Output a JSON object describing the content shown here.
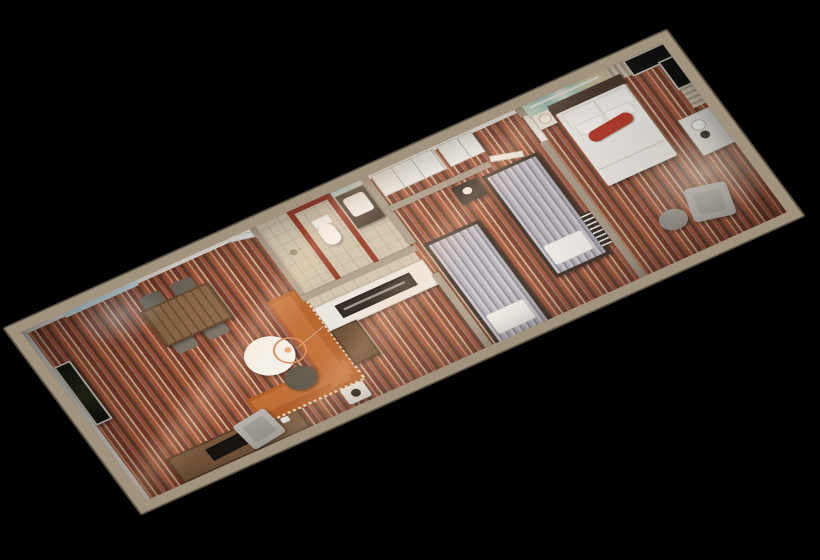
{
  "scene": {
    "type": "3d-floorplan-dollhouse-render",
    "description": "Top-down 3D cutaway rendering of a hotel suite floor plan, rotated diagonally on a solid black background",
    "background_color": "#000000",
    "orientation": "long axis runs from lower-left (living room) to upper-right (master bedroom)",
    "floor_finish": "multicolor striped carpet in rust, brown, cream and gray"
  },
  "palette": {
    "background": "#000000",
    "wall_top": "#a2937f",
    "wall_inner_face": "#f2efe9",
    "carpet_rust": "#a4553a",
    "carpet_brown": "#6b4634",
    "carpet_cream": "#cbb093",
    "bathroom_accent_red": "#8e2f1c",
    "sofa_orange": "#b2591f",
    "wood_brown": "#8a6849",
    "bed_frame_dark": "#382c24",
    "bedding_white": "#f1eeea",
    "bolster_red": "#b53324",
    "mural_turquoise": "#8fcac2",
    "curtain_beige": "#d8cdb9",
    "window_black": "#0b0b0b",
    "tile_beige": "#cdc2ab"
  },
  "rooms": [
    {
      "name": "Living room",
      "position": "left end of unit",
      "furniture": [
        "entry door",
        "window with daylight",
        "framed wall art",
        "TV console with television",
        "wood dining table",
        "four dining chairs",
        "orange L-shaped sectional sofa with dotted trim",
        "round white coffee table",
        "ring pendant lamp",
        "gray armchair",
        "dark ottoman",
        "white side table with bowl"
      ]
    },
    {
      "name": "Kitchenette / hallway",
      "position": "center of unit",
      "furniture": [
        "white counter with dark coffee-bar niche",
        "tall brown cabinet",
        "beige tile hallway"
      ]
    },
    {
      "name": "Bathroom",
      "position": "center, north side",
      "furniture": [
        "shower room",
        "toilet",
        "vanity with sink",
        "mirror",
        "red accent walls",
        "beige tile floor"
      ]
    },
    {
      "name": "Second bedroom",
      "position": "center-right of unit",
      "furniture": [
        "sliding-door closets",
        "twin bed with striped bedspread (x2)",
        "dark dresser",
        "luggage bench with slats"
      ]
    },
    {
      "name": "Master bedroom",
      "position": "right end of unit",
      "furniture": [
        "beach mural wall",
        "double bed with white duvet",
        "dark headboard",
        "white pillows",
        "red bolster pillow",
        "nightstand with lamp",
        "black picture window with beige curtains",
        "white console with coffee tray",
        "gray armchair",
        "round side table"
      ]
    }
  ]
}
